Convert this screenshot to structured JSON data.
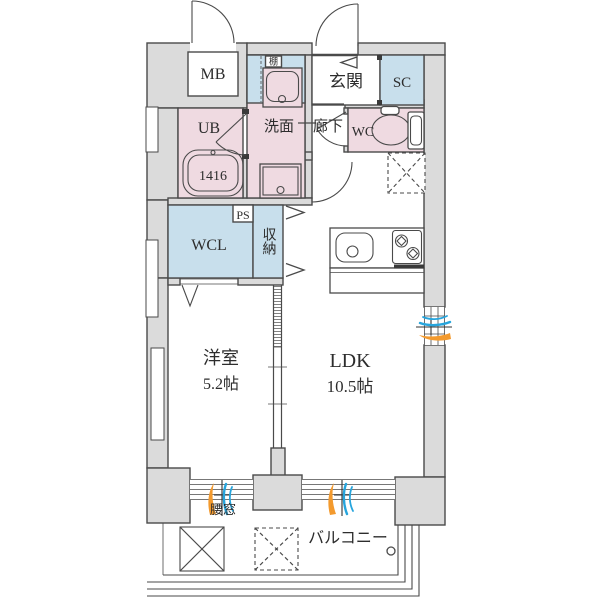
{
  "labels": {
    "meter_box": "MB",
    "shelf": "棚",
    "entrance": "玄関",
    "shoe_closet": "SC",
    "unit_bath": "UB",
    "bathtub_size": "1416",
    "washroom": "洗面",
    "hallway": "廊下",
    "toilet": "WC",
    "pipe_space": "PS",
    "walk_in_closet": "WCL",
    "storage": "収納",
    "western_room": "洋室",
    "western_room_size": "5.2帖",
    "ldk": "LDK",
    "ldk_size": "10.5帖",
    "waist_window": "腰窓",
    "balcony": "バルコニー"
  },
  "colors": {
    "wall_fill": "#dbdbdb",
    "wet_room_fill": "#efdae1",
    "closet_fill": "#c8dfec",
    "outline": "#4a4a4a",
    "vent_warm": "#f39a2e",
    "vent_cool": "#27a5dd"
  }
}
